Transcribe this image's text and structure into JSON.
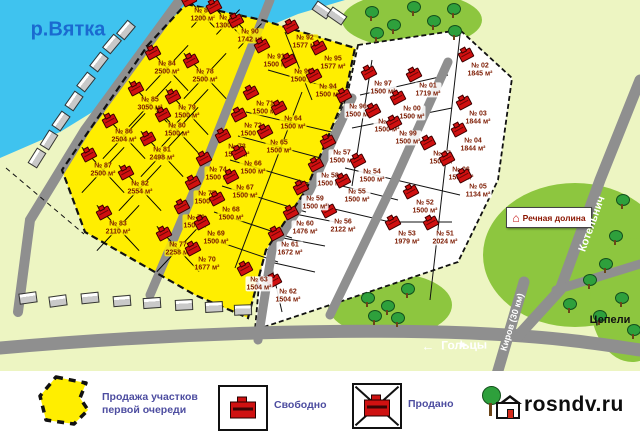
{
  "map": {
    "water_label": "р.Вятка",
    "sign_label": "Речная долина",
    "roads": {
      "golcy": "Гольцы",
      "kirov": "Киров (30 км)",
      "kotelnich": "Котельнич",
      "cepeli": "Цепели",
      "arrow_left": "←",
      "arrow_down": "➤"
    },
    "plots": [
      {
        "n": "№ 88",
        "a": "1200 м²",
        "x": 203,
        "y": 15,
        "z": "y",
        "s": true,
        "sm": true
      },
      {
        "n": "№ 89",
        "a": "1300 м²",
        "x": 228,
        "y": 22,
        "z": "y",
        "s": true,
        "sm": true
      },
      {
        "n": "№ 90",
        "a": "1742 м²",
        "x": 250,
        "y": 36,
        "z": "y",
        "s": true,
        "sm": true
      },
      {
        "n": "№ 84",
        "a": "2500 м²",
        "x": 167,
        "y": 68,
        "z": "y",
        "s": true
      },
      {
        "n": "№ 78",
        "a": "2500 м²",
        "x": 205,
        "y": 76,
        "z": "y",
        "s": true
      },
      {
        "n": "№ 85",
        "a": "3050 м²",
        "x": 150,
        "y": 104,
        "z": "y",
        "s": true
      },
      {
        "n": "№ 79",
        "a": "1500 м²",
        "x": 187,
        "y": 112,
        "z": "y",
        "s": true
      },
      {
        "n": "№ 86",
        "a": "2504 м²",
        "x": 124,
        "y": 136,
        "z": "y",
        "s": true
      },
      {
        "n": "№ 80",
        "a": "1500 м²",
        "x": 177,
        "y": 130,
        "z": "y",
        "s": true
      },
      {
        "n": "№ 81",
        "a": "2498 м²",
        "x": 162,
        "y": 154,
        "z": "y",
        "s": true
      },
      {
        "n": "№ 87",
        "a": "2500 м²",
        "x": 103,
        "y": 170,
        "z": "y",
        "s": true
      },
      {
        "n": "№ 82",
        "a": "2554 м²",
        "x": 140,
        "y": 188,
        "z": "y",
        "s": true
      },
      {
        "n": "№ 83",
        "a": "2110 м²",
        "x": 118,
        "y": 228,
        "z": "y",
        "s": true
      },
      {
        "n": "№ 77",
        "a": "2258 м²",
        "x": 178,
        "y": 249,
        "z": "y",
        "s": true
      },
      {
        "n": "№ 92",
        "a": "1577 м²",
        "x": 305,
        "y": 42,
        "z": "y",
        "s": false
      },
      {
        "n": "№ 95",
        "a": "1577 м²",
        "x": 333,
        "y": 63,
        "z": "y",
        "s": false
      },
      {
        "n": "№ 91",
        "a": "1500 м²",
        "x": 276,
        "y": 61,
        "z": "y",
        "s": false
      },
      {
        "n": "№ 93",
        "a": "1500 м²",
        "x": 303,
        "y": 76,
        "z": "y",
        "s": false
      },
      {
        "n": "№ 94",
        "a": "1500 м²",
        "x": 328,
        "y": 91,
        "z": "y",
        "s": false
      },
      {
        "n": "№ 71",
        "a": "1500 м²",
        "x": 265,
        "y": 108,
        "z": "y",
        "s": false
      },
      {
        "n": "№ 72",
        "a": "1500 м²",
        "x": 253,
        "y": 130,
        "z": "y",
        "s": false
      },
      {
        "n": "№ 73",
        "a": "1500 м²",
        "x": 237,
        "y": 151,
        "z": "y",
        "s": false
      },
      {
        "n": "№ 74",
        "a": "1500 м²",
        "x": 218,
        "y": 174,
        "z": "y",
        "s": false
      },
      {
        "n": "№ 75",
        "a": "1500 м²",
        "x": 207,
        "y": 198,
        "z": "y",
        "s": false
      },
      {
        "n": "№ 76",
        "a": "1500 м²",
        "x": 196,
        "y": 222,
        "z": "y",
        "s": false
      },
      {
        "n": "№ 70",
        "a": "1677 м²",
        "x": 207,
        "y": 264,
        "z": "y",
        "s": false
      },
      {
        "n": "№ 64",
        "a": "1500 м²",
        "x": 293,
        "y": 123,
        "z": "y",
        "s": false
      },
      {
        "n": "№ 65",
        "a": "1500 м²",
        "x": 279,
        "y": 147,
        "z": "y",
        "s": false
      },
      {
        "n": "№ 66",
        "a": "1500 м²",
        "x": 253,
        "y": 168,
        "z": "y",
        "s": false
      },
      {
        "n": "№ 67",
        "a": "1500 м²",
        "x": 245,
        "y": 192,
        "z": "y",
        "s": false
      },
      {
        "n": "№ 68",
        "a": "1500 м²",
        "x": 231,
        "y": 214,
        "z": "y",
        "s": false
      },
      {
        "n": "№ 69",
        "a": "1500 м²",
        "x": 216,
        "y": 238,
        "z": "y",
        "s": false
      },
      {
        "n": "№ 97",
        "a": "1500 м²",
        "x": 383,
        "y": 88,
        "z": "w",
        "s": false
      },
      {
        "n": "№ 01",
        "a": "1719 м²",
        "x": 428,
        "y": 90,
        "z": "w",
        "s": false
      },
      {
        "n": "№ 02",
        "a": "1845 м²",
        "x": 480,
        "y": 70,
        "z": "w",
        "s": false
      },
      {
        "n": "№ 96",
        "a": "1500 м²",
        "x": 358,
        "y": 111,
        "z": "w",
        "s": false
      },
      {
        "n": "№ 00",
        "a": "1500 м²",
        "x": 412,
        "y": 113,
        "z": "w",
        "s": false
      },
      {
        "n": "№ 03",
        "a": "1844 м²",
        "x": 478,
        "y": 118,
        "z": "w",
        "s": false
      },
      {
        "n": "№ 98",
        "a": "1500 м²",
        "x": 387,
        "y": 126,
        "z": "w",
        "s": false
      },
      {
        "n": "№ 99",
        "a": "1500 м²",
        "x": 408,
        "y": 138,
        "z": "w",
        "s": false
      },
      {
        "n": "№ 04",
        "a": "1844 м²",
        "x": 473,
        "y": 145,
        "z": "w",
        "s": false
      },
      {
        "n": "№ 07",
        "a": "1500 м²",
        "x": 442,
        "y": 158,
        "z": "w",
        "s": false
      },
      {
        "n": "№ 06",
        "a": "1500 м²",
        "x": 461,
        "y": 174,
        "z": "w",
        "s": false
      },
      {
        "n": "№ 05",
        "a": "1134 м²",
        "x": 478,
        "y": 191,
        "z": "w",
        "s": false
      },
      {
        "n": "№ 57",
        "a": "1500 м²",
        "x": 342,
        "y": 157,
        "z": "w",
        "s": false
      },
      {
        "n": "№ 58",
        "a": "1500 м²",
        "x": 330,
        "y": 180,
        "z": "w",
        "s": false
      },
      {
        "n": "№ 54",
        "a": "1500 м²",
        "x": 372,
        "y": 176,
        "z": "w",
        "s": false
      },
      {
        "n": "№ 55",
        "a": "1500 м²",
        "x": 357,
        "y": 196,
        "z": "w",
        "s": false
      },
      {
        "n": "№ 56",
        "a": "2122 м²",
        "x": 343,
        "y": 226,
        "z": "w",
        "s": false
      },
      {
        "n": "№ 52",
        "a": "1500 м²",
        "x": 425,
        "y": 207,
        "z": "w",
        "s": false
      },
      {
        "n": "№ 53",
        "a": "1979 м²",
        "x": 407,
        "y": 238,
        "z": "w",
        "s": false
      },
      {
        "n": "№ 51",
        "a": "2024 м²",
        "x": 445,
        "y": 238,
        "z": "w",
        "s": false
      },
      {
        "n": "№ 59",
        "a": "1500 м²",
        "x": 315,
        "y": 203,
        "z": "w",
        "s": false
      },
      {
        "n": "№ 60",
        "a": "1476 м²",
        "x": 305,
        "y": 228,
        "z": "w",
        "s": false
      },
      {
        "n": "№ 61",
        "a": "1672 м²",
        "x": 290,
        "y": 249,
        "z": "w",
        "s": false
      },
      {
        "n": "№ 62",
        "a": "1504 м²",
        "x": 288,
        "y": 296,
        "z": "w",
        "s": false
      },
      {
        "n": "№ 63",
        "a": "1504 м²",
        "x": 259,
        "y": 284,
        "z": "w",
        "s": false
      }
    ],
    "trees": [
      [
        372,
        14
      ],
      [
        394,
        27
      ],
      [
        414,
        9
      ],
      [
        434,
        23
      ],
      [
        454,
        11
      ],
      [
        377,
        35
      ],
      [
        455,
        33
      ],
      [
        623,
        202
      ],
      [
        616,
        238
      ],
      [
        606,
        266
      ],
      [
        590,
        282
      ],
      [
        622,
        300
      ],
      [
        600,
        318
      ],
      [
        570,
        306
      ],
      [
        368,
        300
      ],
      [
        388,
        308
      ],
      [
        408,
        291
      ],
      [
        375,
        318
      ],
      [
        398,
        320
      ],
      [
        634,
        332
      ]
    ],
    "village_houses": [
      [
        126,
        30,
        -50
      ],
      [
        112,
        44,
        -50
      ],
      [
        99,
        62,
        -52
      ],
      [
        86,
        82,
        -52
      ],
      [
        74,
        101,
        -55
      ],
      [
        61,
        121,
        -55
      ],
      [
        49,
        140,
        -58
      ],
      [
        37,
        158,
        -58
      ],
      [
        28,
        298,
        -8
      ],
      [
        58,
        301,
        -8
      ],
      [
        90,
        298,
        -6
      ],
      [
        122,
        301,
        -5
      ],
      [
        152,
        303,
        -4
      ],
      [
        184,
        305,
        -3
      ],
      [
        214,
        307,
        -3
      ],
      [
        243,
        310,
        -2
      ],
      [
        322,
        10,
        35
      ],
      [
        337,
        16,
        35
      ]
    ]
  },
  "legend": {
    "first_phase": "Продажа участков первой очереди",
    "free": "Свободно",
    "sold": "Продано"
  },
  "logo_text": "rosndv.ru",
  "colors": {
    "water": "#3fc3ef",
    "land": "#edf5c2",
    "forest": "#8dc63f",
    "plot_yellow": "#ffee00",
    "road": "#8f8f8f",
    "plot_text": "#7c1b02",
    "legend_text": "#4d4da0",
    "house_red": "#d01010"
  }
}
